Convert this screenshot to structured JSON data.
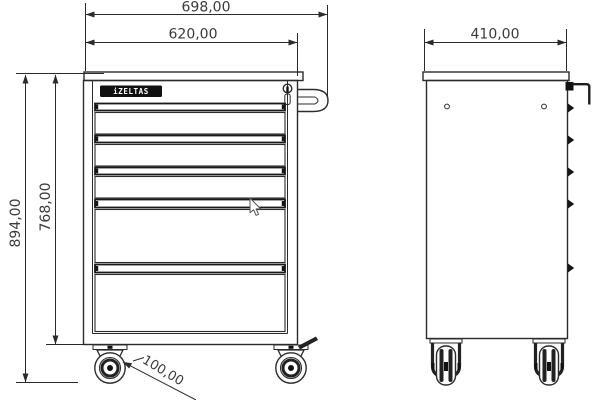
{
  "drawing": {
    "background_color": "#ffffff",
    "line_color": "#2b2b2b",
    "text_color": "#3a3a3a",
    "brand_badge": {
      "label": "iZELTAS",
      "bg": "#101010",
      "fg": "#ffffff"
    },
    "dimensions": {
      "overall_width": "698,00",
      "cabinet_width": "620,00",
      "overall_height": "894,00",
      "cabinet_height": "768,00",
      "depth": "410,00",
      "caster_diameter": "100,00"
    },
    "front_view": {
      "drawers_small": 3,
      "drawers_large": 2,
      "casters": 2
    },
    "side_view": {
      "screw_holes": 2,
      "drawer_edge_tabs": 5,
      "casters": 2
    }
  }
}
